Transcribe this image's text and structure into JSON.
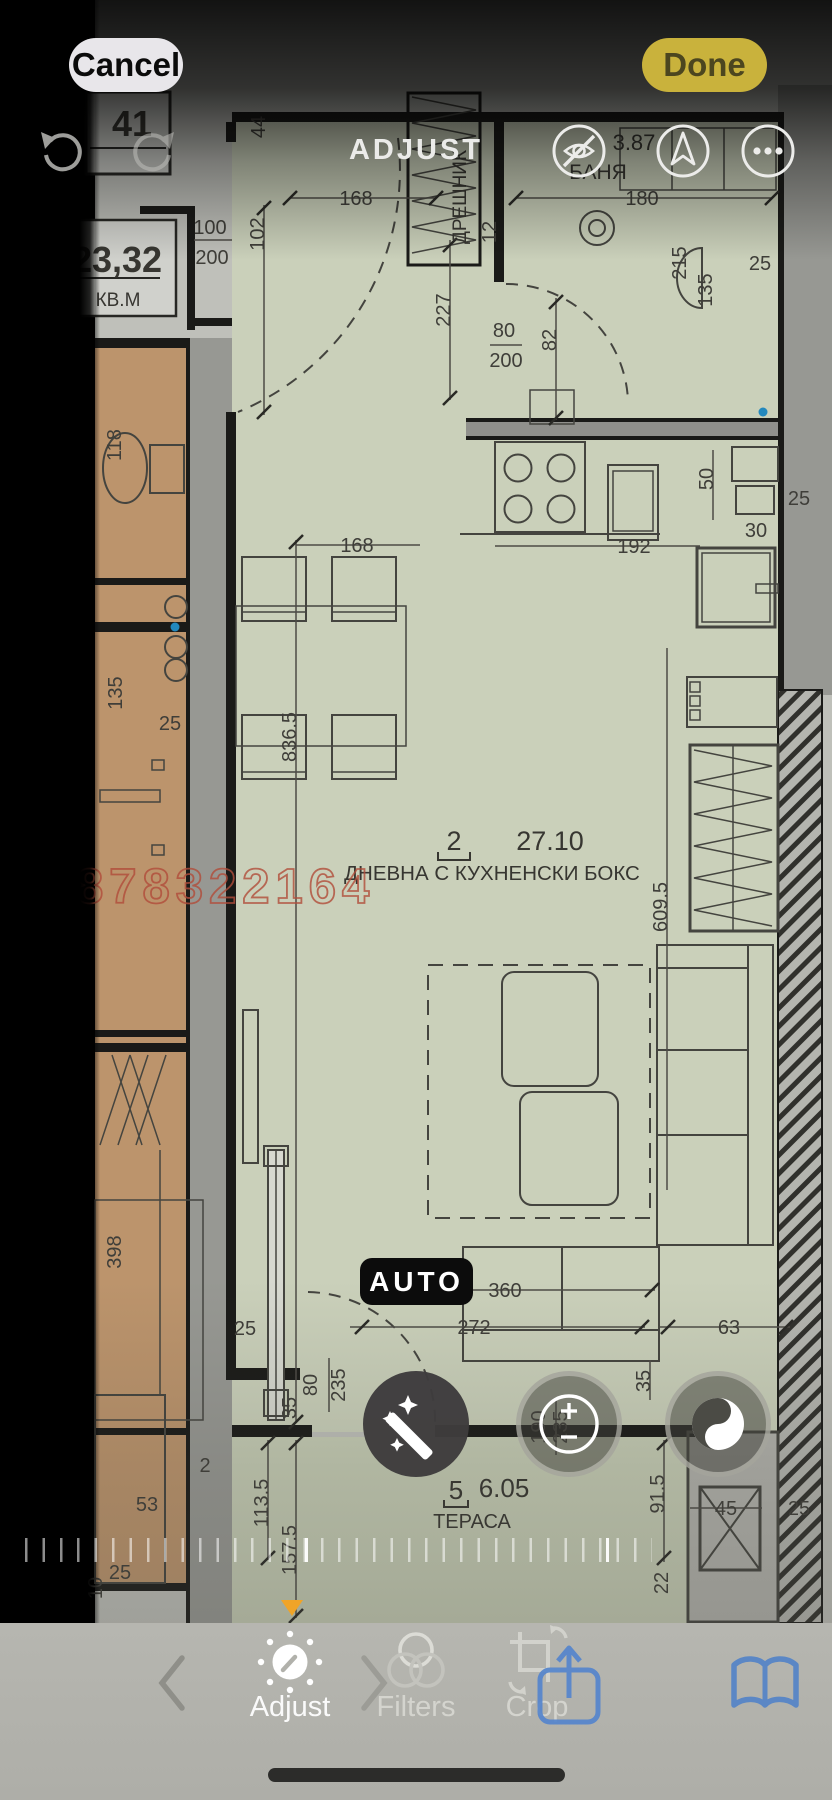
{
  "chrome": {
    "cancel_label": "Cancel",
    "done_label": "Done",
    "title": "ADJUST",
    "auto_label": "AUTO",
    "tab_adjust": "Adjust",
    "tab_filters": "Filters",
    "tab_crop": "Crop",
    "done_accent_color": "#c9b23c",
    "slider_indicator_color": "#f0a427",
    "link_blue_color": "#5585cd"
  },
  "floorplan": {
    "watermark": "0878322164",
    "unit_number": "41",
    "unit_area": "23,32",
    "unit_area_unit": "КВ.М",
    "room_number": "2",
    "room_area": "27.10",
    "room_name": "ДНЕВНА С КУХНЕНСКИ БОКС",
    "bathroom_name": "БАНЯ",
    "bathroom_area": "3.87",
    "closet_label": "ДРЕШНИК",
    "terrace_number": "5",
    "terrace_area": "6.05",
    "terrace_name": "ТЕРАСА",
    "dims": [
      "168",
      "100",
      "200",
      "102",
      "44",
      "227",
      "80",
      "200",
      "82",
      "180",
      "215",
      "135",
      "25",
      "192",
      "50",
      "25",
      "30",
      "168",
      "836.5",
      "609.5",
      "118",
      "135",
      "25",
      "398",
      "25",
      "80",
      "235",
      "35",
      "2",
      "53",
      "25",
      "113.5",
      "157.5",
      "360",
      "272",
      "63",
      "35",
      "190",
      "235",
      "91.5",
      "45",
      "22",
      "25",
      "12",
      "10"
    ]
  }
}
